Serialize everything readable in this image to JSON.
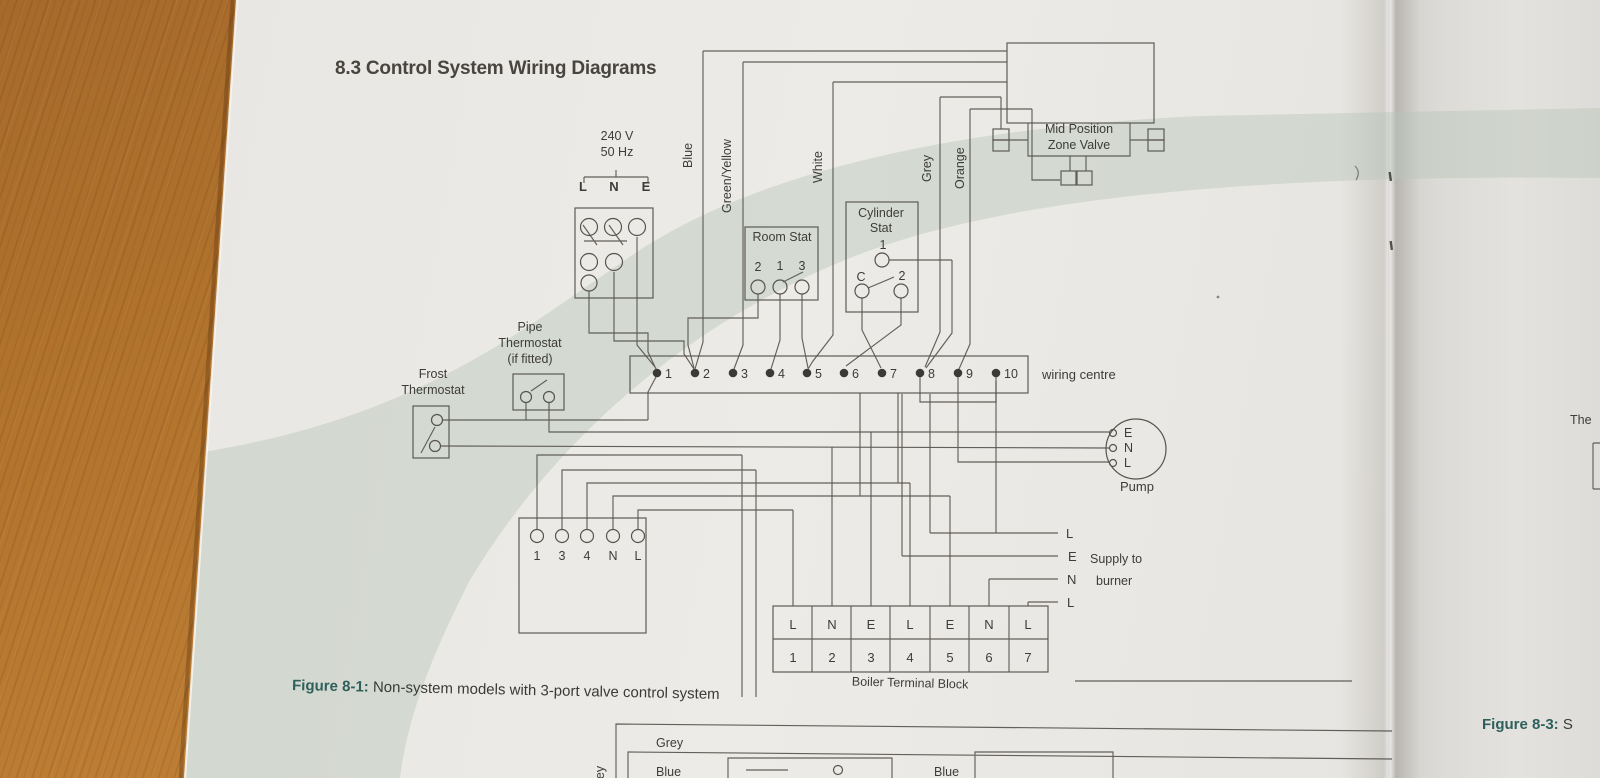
{
  "page": {
    "title": "8.3 Control System Wiring Diagrams",
    "caption_prefix": "Figure 8-1:",
    "caption_text": " Non-system models with 3-port valve control system"
  },
  "supply": {
    "voltage": "240 V",
    "frequency": "50 Hz",
    "l": "L",
    "n": "N",
    "e": "E"
  },
  "wire_labels": {
    "blue": "Blue",
    "green_yellow": "Green/Yellow",
    "white": "White",
    "grey": "Grey",
    "orange": "Orange"
  },
  "zone_valve": {
    "line1": "Mid Position",
    "line2": "Zone Valve"
  },
  "room_stat": {
    "title": "Room Stat",
    "t_left": "2",
    "t_mid": "1",
    "t_right": "3"
  },
  "cylinder_stat": {
    "line1": "Cylinder",
    "line2": "Stat",
    "t_top": "1",
    "t_left": "C",
    "t_right": "2"
  },
  "pipe_thermostat": {
    "line1": "Pipe",
    "line2": "Thermostat",
    "line3": "(if fitted)"
  },
  "frost_thermostat": {
    "line1": "Frost",
    "line2": "Thermostat"
  },
  "wiring_centre": {
    "label": "wiring centre",
    "terminals": [
      "1",
      "2",
      "3",
      "4",
      "5",
      "6",
      "7",
      "8",
      "9",
      "10"
    ]
  },
  "programmer": {
    "terminals": [
      "1",
      "3",
      "4",
      "N",
      "L"
    ]
  },
  "pump": {
    "label": "Pump",
    "e": "E",
    "n": "N",
    "l": "L"
  },
  "burner": {
    "t1": "L",
    "t2": "E",
    "t3": "N",
    "t4": "L",
    "line1": "Supply to",
    "line2": "burner"
  },
  "boiler_block": {
    "label": "Boiler Terminal Block",
    "row1": [
      "L",
      "N",
      "E",
      "L",
      "E",
      "N",
      "L"
    ],
    "row2": [
      "1",
      "2",
      "3",
      "4",
      "5",
      "6",
      "7"
    ]
  },
  "diagram2": {
    "grey": "Grey",
    "blue": "Blue",
    "grey_vertical": "Grey",
    "blue_right": "Blue"
  },
  "right_page": {
    "partial_text": "The",
    "caption_prefix": "Figure 8-3:",
    "caption_text": " S"
  },
  "colors": {
    "caption_accent": "#2e5f5b",
    "line": "#57544f",
    "sage_swoosh": "#b9c5b9",
    "paper": "#e9e7e3",
    "wood": "#b4762f"
  }
}
